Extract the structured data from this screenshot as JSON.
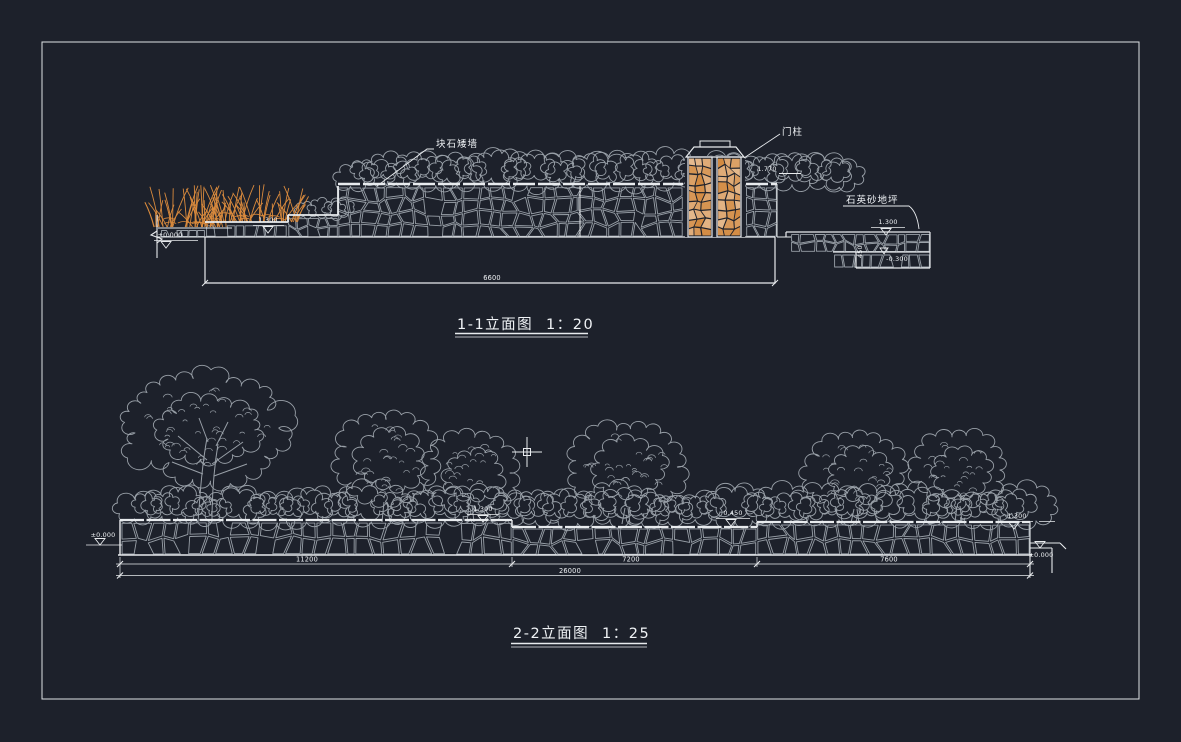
{
  "canvas": {
    "background": "#1d212b",
    "frame_color": "#e8ebee",
    "linework_gray": "#99a0a8",
    "linework_white": "#e8ebee",
    "accent_orange": "#d98a3d",
    "text_color": "#f0f3f6"
  },
  "drawing1": {
    "title": "1-1立面图",
    "scale": "1：20",
    "labels": {
      "wall": "块石矮墙",
      "gate_post": "门柱",
      "paving": "石英砂地坪"
    },
    "dimensions": {
      "overall": "6600",
      "step_height": "450"
    },
    "elevations": {
      "wall_left_top": "1.300",
      "ground_left": "±0.000",
      "post_top": "1.770",
      "right_upper": "1.300",
      "right_lower": "-0.300"
    }
  },
  "drawing2": {
    "title": "2-2立面图",
    "scale": "1：25",
    "dimensions": {
      "seg1": "11200",
      "seg2": "7200",
      "seg3": "7600",
      "overall": "26000"
    },
    "elevations": {
      "ground_left": "±0.000",
      "wall_top_left": "1.300",
      "wall_top_mid": "0.450",
      "wall_top_right": "1.300",
      "ground_right": "±0.000"
    }
  }
}
